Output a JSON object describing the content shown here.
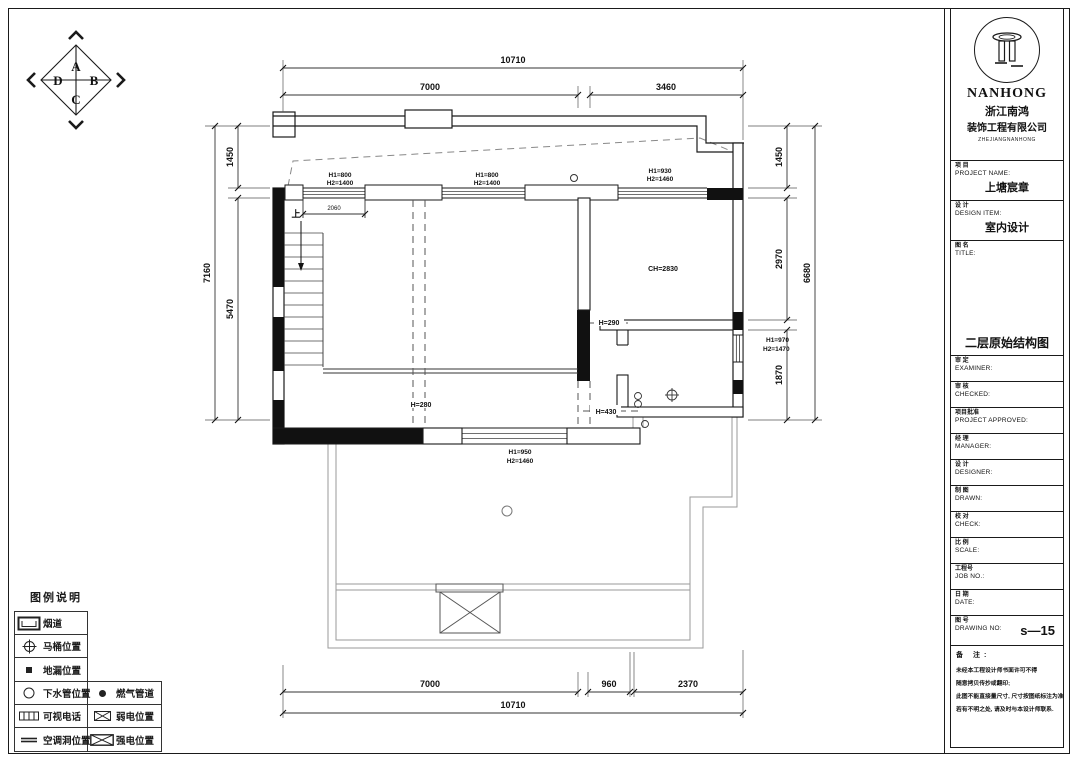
{
  "orientation": {
    "a": "A",
    "b": "B",
    "c": "C",
    "d": "D"
  },
  "plan": {
    "dims": {
      "top_total": "10710",
      "top_a": "7000",
      "top_b": "3460",
      "bottom_a": "7000",
      "bottom_b": "960",
      "bottom_c": "2370",
      "bottom_total": "10710",
      "left_outer": "7160",
      "left_a": "1450",
      "left_b": "5470",
      "right_outer": "6680",
      "right_a": "1450",
      "right_b": "2970",
      "right_c": "1870",
      "stair": "2060"
    },
    "labels": {
      "up": "上",
      "w_top1_l1": "H1=800",
      "w_top1_l2": "H2=1400",
      "w_top2_l1": "H1=800",
      "w_top2_l2": "H2=1400",
      "w_top3_l1": "H1=930",
      "w_top3_l2": "H2=1460",
      "w_right_l1": "H1=970",
      "w_right_l2": "H2=1470",
      "w_bottom_l1": "H1=950",
      "w_bottom_l2": "H2=1460",
      "ch": "CH=2830",
      "h290": "H=290",
      "h430": "H=430",
      "h280": "H=280"
    }
  },
  "legend": {
    "title": "图例说明",
    "rows": [
      {
        "label": "烟道"
      },
      {
        "label": "马桶位置"
      },
      {
        "label": "地漏位置"
      },
      {
        "label": "下水管位置",
        "label2": "燃气管道"
      },
      {
        "label": "可视电话",
        "label2": "弱电位置"
      },
      {
        "label": "空调洞位置",
        "label2": "强电位置"
      }
    ]
  },
  "titleblock": {
    "logo": {
      "name": "NANHONG",
      "cn1": "浙江南鸿",
      "cn2": "装饰工程有限公司",
      "sub": "ZHEJIANGNANHONG"
    },
    "project": {
      "cn": "项 目",
      "en": "PROJECT NAME:",
      "value": "上塘宸章"
    },
    "design": {
      "cn": "设 计",
      "en": "DESIGN ITEM:",
      "value": "室内设计"
    },
    "title": {
      "cn": "图 名",
      "en": "TITLE:",
      "value": "二层原始结构图"
    },
    "rows": [
      {
        "cn": "审 定",
        "en": "EXAMINER:"
      },
      {
        "cn": "审 核",
        "en": "CHECKED:"
      },
      {
        "cn": "项目批准",
        "en": "PROJECT APPROVED:"
      },
      {
        "cn": "经 理",
        "en": "MANAGER:"
      },
      {
        "cn": "设 计",
        "en": "DESIGNER:"
      },
      {
        "cn": "制 图",
        "en": "DRAWN:"
      },
      {
        "cn": "校 对",
        "en": "CHECK:"
      },
      {
        "cn": "比 例",
        "en": "SCALE:"
      },
      {
        "cn": "工程号",
        "en": "JOB NO.:"
      },
      {
        "cn": "日 期",
        "en": "DATE:"
      }
    ],
    "drawing_no": {
      "cn": "图 号",
      "en": "DRAWING NO:",
      "value": "s—15"
    },
    "notes": {
      "title": "备  注:",
      "lines": [
        "未经本工程设计师书面许可不得",
        "随意拷贝传抄或翻印;",
        "此图不能直接量尺寸, 尺寸按图纸标注为准",
        "若有不明之处, 请及时与本设计师联系."
      ]
    }
  }
}
